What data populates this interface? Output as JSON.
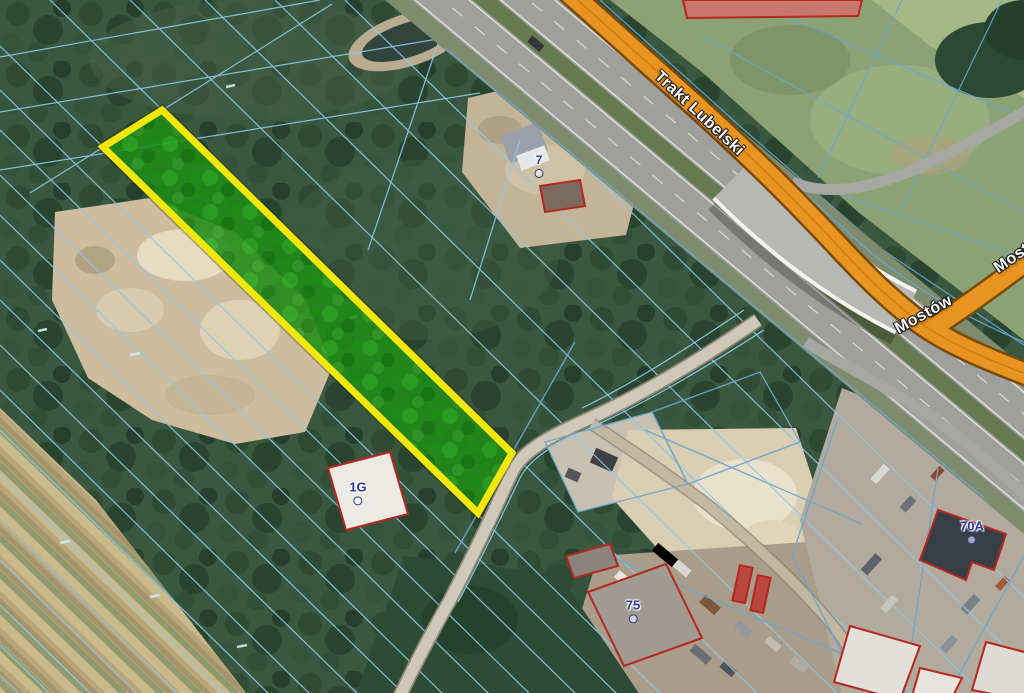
{
  "labels": {
    "road_trakt_lubelski": "Trakt Lubelski",
    "road_mostow": "Mostów",
    "road_mostow_clipped": "Mostów",
    "addr_7": "7",
    "addr_1g": "1G",
    "addr_75": "75",
    "addr_70a": "70A"
  },
  "colors": {
    "parcel-outline": "#f2e70c",
    "parcel-fill": "#1f8c17",
    "road-highlight": "#e89420",
    "road-casing": "#7a4a08",
    "building-outline": "#b5271f",
    "cadastral-line": "#8fc8ea",
    "cadastral-line-strong": "#6aa6d2",
    "address-label": "#2b3a96",
    "road-label-text": "#ffffff"
  }
}
